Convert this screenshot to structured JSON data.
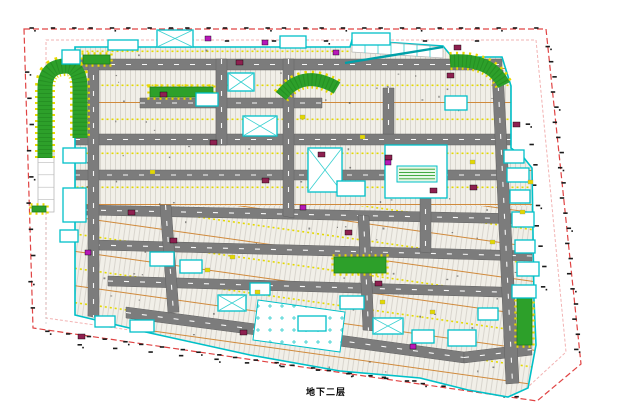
{
  "label": {
    "text": "地下二层"
  },
  "canvas": {
    "w": 627,
    "h": 415,
    "bg": "#ffffff"
  },
  "colors": {
    "boundary_red": "#e04343",
    "boundary_pink": "#f2b3b3",
    "outline_cyan": "#00c0c8",
    "teal_dark": "#00a0a8",
    "road_gray": "#7c7c7c",
    "road_edge": "#626262",
    "stall_bg": "#f1efe8",
    "stall_line": "#c9c5bd",
    "stall_orange": "#d08a3c",
    "lane_yellow": "#e3d800",
    "green_fill": "#2da02a",
    "green_edge": "#1e7f1c",
    "hedge_yellow": "#ead800",
    "maroon": "#8e2050",
    "magenta": "#b818b8",
    "tick_black": "#1a1a1a",
    "white": "#ffffff",
    "cross_cyan": "#38d0d0",
    "ramp_gray": "#b8b8b8"
  },
  "boundary": {
    "outer": [
      [
        24,
        29
      ],
      [
        546,
        29
      ],
      [
        581,
        364
      ],
      [
        537,
        401
      ],
      [
        33,
        328
      ]
    ],
    "inner": [
      [
        46,
        40
      ],
      [
        536,
        40
      ],
      [
        566,
        352
      ],
      [
        528,
        387
      ],
      [
        46,
        318
      ]
    ]
  },
  "tick_rows": [
    {
      "a": [
        24,
        29
      ],
      "b": [
        546,
        29
      ],
      "n": 27
    },
    {
      "a": [
        549,
        40
      ],
      "b": [
        579,
        358
      ],
      "n": 21
    },
    {
      "a": [
        529,
        115
      ],
      "b": [
        545,
        298
      ],
      "n": 9
    },
    {
      "a": [
        40,
        331
      ],
      "b": [
        528,
        399
      ],
      "n": 26
    },
    {
      "a": [
        65,
        344
      ],
      "b": [
        500,
        391
      ],
      "n": 13
    },
    {
      "a": [
        29,
        60
      ],
      "b": [
        32,
        322
      ],
      "n": 10
    },
    {
      "a": [
        100,
        42
      ],
      "b": [
        500,
        42
      ],
      "n": 8
    }
  ],
  "garage": {
    "outline": [
      [
        75,
        47
      ],
      [
        350,
        47
      ],
      [
        352,
        40
      ],
      [
        443,
        46
      ],
      [
        452,
        57
      ],
      [
        502,
        57
      ],
      [
        511,
        86
      ],
      [
        511,
        148
      ],
      [
        524,
        158
      ],
      [
        532,
        168
      ],
      [
        534,
        300
      ],
      [
        536,
        345
      ],
      [
        528,
        388
      ],
      [
        508,
        397
      ],
      [
        468,
        390
      ],
      [
        420,
        378
      ],
      [
        340,
        371
      ],
      [
        250,
        355
      ],
      [
        150,
        333
      ],
      [
        75,
        315
      ]
    ],
    "pattern_split_y": 206,
    "noise_count": 150,
    "noise_seed": 7
  },
  "roads": {
    "h": [
      [
        [
          78,
          59
        ],
        [
          502,
          59
        ],
        [
          502,
          70
        ],
        [
          78,
          70
        ]
      ],
      [
        [
          140,
          98
        ],
        [
          322,
          98
        ],
        [
          322,
          108
        ],
        [
          140,
          108
        ]
      ],
      [
        [
          75,
          134
        ],
        [
          524,
          134
        ],
        [
          524,
          145
        ],
        [
          75,
          145
        ]
      ],
      [
        [
          75,
          170
        ],
        [
          526,
          170
        ],
        [
          526,
          180
        ],
        [
          75,
          180
        ]
      ],
      [
        [
          85,
          205
        ],
        [
          529,
          214
        ],
        [
          529,
          224
        ],
        [
          85,
          215
        ]
      ],
      [
        [
          95,
          240
        ],
        [
          532,
          251
        ],
        [
          532,
          261
        ],
        [
          95,
          250
        ]
      ],
      [
        [
          108,
          276
        ],
        [
          534,
          288
        ],
        [
          534,
          298
        ],
        [
          108,
          286
        ]
      ],
      [
        [
          126,
          307
        ],
        [
          302,
          330
        ],
        [
          302,
          341
        ],
        [
          126,
          318
        ]
      ],
      [
        [
          302,
          330
        ],
        [
          464,
          352
        ],
        [
          464,
          363
        ],
        [
          302,
          341
        ]
      ],
      [
        [
          464,
          352
        ],
        [
          531,
          344
        ],
        [
          532,
          355
        ],
        [
          464,
          363
        ]
      ]
    ],
    "v": [
      [
        [
          88,
          59
        ],
        [
          99,
          59
        ],
        [
          99,
          318
        ],
        [
          88,
          316
        ]
      ],
      [
        [
          216,
          59
        ],
        [
          227,
          59
        ],
        [
          227,
          145
        ],
        [
          216,
          145
        ]
      ],
      [
        [
          283,
          59
        ],
        [
          294,
          59
        ],
        [
          294,
          218
        ],
        [
          283,
          216
        ]
      ],
      [
        [
          383,
          88
        ],
        [
          394,
          88
        ],
        [
          394,
          134
        ],
        [
          383,
          134
        ]
      ],
      [
        [
          420,
          145
        ],
        [
          431,
          145
        ],
        [
          431,
          253
        ],
        [
          420,
          252
        ]
      ],
      [
        [
          492,
          70
        ],
        [
          503,
          70
        ],
        [
          519,
          383
        ],
        [
          506,
          384
        ]
      ],
      [
        [
          160,
          205
        ],
        [
          171,
          205
        ],
        [
          179,
          312
        ],
        [
          168,
          313
        ]
      ],
      [
        [
          358,
          215
        ],
        [
          369,
          216
        ],
        [
          374,
          331
        ],
        [
          363,
          330
        ]
      ]
    ]
  },
  "ramp": {
    "outline": [
      [
        352,
        40
      ],
      [
        443,
        47
      ],
      [
        443,
        58
      ],
      [
        352,
        52
      ]
    ],
    "stripes": 6,
    "edge": [
      [
        345,
        63
      ],
      [
        443,
        47
      ]
    ]
  },
  "left_ramp": {
    "x": 38,
    "y": 150,
    "w": 16,
    "h": 62
  },
  "plaza": {
    "outline": [
      [
        258,
        300
      ],
      [
        345,
        312
      ],
      [
        340,
        352
      ],
      [
        253,
        340
      ]
    ]
  },
  "greens": {
    "strokes": [
      {
        "d": "M 45 158 L 45 88 Q 45 66 66 66 Q 80 66 80 88 L 80 138",
        "w": 15
      },
      {
        "d": "M 281 96 Q 303 68 337 88",
        "w": 13
      },
      {
        "d": "M 450 61 Q 491 58 504 85",
        "w": 13
      }
    ],
    "bars": [
      {
        "x": 83,
        "y": 55,
        "w": 27,
        "h": 9
      },
      {
        "x": 150,
        "y": 87,
        "w": 63,
        "h": 10
      },
      {
        "x": 334,
        "y": 257,
        "w": 52,
        "h": 16
      },
      {
        "x": 517,
        "y": 297,
        "w": 15,
        "h": 48
      },
      {
        "x": 32,
        "y": 206,
        "w": 14,
        "h": 6
      }
    ]
  },
  "cores": [
    {
      "x": 108,
      "y": 40,
      "w": 30,
      "h": 10
    },
    {
      "x": 157,
      "y": 30,
      "w": 36,
      "h": 17,
      "d": 1
    },
    {
      "x": 352,
      "y": 33,
      "w": 38,
      "h": 12
    },
    {
      "x": 280,
      "y": 36,
      "w": 26,
      "h": 12
    },
    {
      "x": 62,
      "y": 50,
      "w": 18,
      "h": 14
    },
    {
      "x": 228,
      "y": 73,
      "w": 26,
      "h": 18,
      "d": 1
    },
    {
      "x": 196,
      "y": 93,
      "w": 22,
      "h": 13
    },
    {
      "x": 243,
      "y": 116,
      "w": 34,
      "h": 20,
      "d": 1
    },
    {
      "x": 445,
      "y": 96,
      "w": 22,
      "h": 14
    },
    {
      "x": 308,
      "y": 148,
      "w": 34,
      "h": 44,
      "d": 1
    },
    {
      "x": 385,
      "y": 145,
      "w": 62,
      "h": 53
    },
    {
      "x": 337,
      "y": 181,
      "w": 28,
      "h": 15
    },
    {
      "x": 63,
      "y": 148,
      "w": 23,
      "h": 15
    },
    {
      "x": 63,
      "y": 188,
      "w": 23,
      "h": 34
    },
    {
      "x": 60,
      "y": 230,
      "w": 18,
      "h": 12
    },
    {
      "x": 504,
      "y": 150,
      "w": 20,
      "h": 13
    },
    {
      "x": 507,
      "y": 168,
      "w": 22,
      "h": 14
    },
    {
      "x": 510,
      "y": 190,
      "w": 20,
      "h": 13
    },
    {
      "x": 512,
      "y": 212,
      "w": 22,
      "h": 15
    },
    {
      "x": 515,
      "y": 240,
      "w": 20,
      "h": 13
    },
    {
      "x": 517,
      "y": 262,
      "w": 22,
      "h": 14
    },
    {
      "x": 512,
      "y": 285,
      "w": 24,
      "h": 13
    },
    {
      "x": 150,
      "y": 252,
      "w": 24,
      "h": 14
    },
    {
      "x": 180,
      "y": 260,
      "w": 22,
      "h": 13
    },
    {
      "x": 218,
      "y": 295,
      "w": 28,
      "h": 16,
      "d": 1
    },
    {
      "x": 250,
      "y": 283,
      "w": 20,
      "h": 12
    },
    {
      "x": 298,
      "y": 316,
      "w": 28,
      "h": 15
    },
    {
      "x": 340,
      "y": 296,
      "w": 24,
      "h": 13
    },
    {
      "x": 373,
      "y": 318,
      "w": 30,
      "h": 16,
      "d": 1
    },
    {
      "x": 412,
      "y": 330,
      "w": 22,
      "h": 13
    },
    {
      "x": 448,
      "y": 330,
      "w": 28,
      "h": 16
    },
    {
      "x": 478,
      "y": 308,
      "w": 20,
      "h": 12
    },
    {
      "x": 95,
      "y": 316,
      "w": 20,
      "h": 11
    },
    {
      "x": 130,
      "y": 320,
      "w": 24,
      "h": 12
    }
  ],
  "atrium": {
    "x": 397,
    "y": 166,
    "w": 40,
    "h": 16
  },
  "accents": {
    "maroon": [
      [
        160,
        92
      ],
      [
        236,
        60
      ],
      [
        454,
        45
      ],
      [
        210,
        140
      ],
      [
        262,
        178
      ],
      [
        318,
        152
      ],
      [
        430,
        188
      ],
      [
        128,
        210
      ],
      [
        170,
        238
      ],
      [
        345,
        230
      ],
      [
        375,
        281
      ],
      [
        240,
        330
      ],
      [
        447,
        73
      ],
      [
        385,
        155
      ],
      [
        470,
        185
      ],
      [
        78,
        334
      ],
      [
        513,
        122
      ]
    ],
    "magenta": [
      [
        205,
        36
      ],
      [
        333,
        50
      ],
      [
        385,
        160
      ],
      [
        300,
        205
      ],
      [
        410,
        344
      ],
      [
        85,
        250
      ],
      [
        262,
        40
      ]
    ],
    "yellow": [
      [
        300,
        115
      ],
      [
        360,
        135
      ],
      [
        470,
        160
      ],
      [
        520,
        210
      ],
      [
        490,
        240
      ],
      [
        380,
        300
      ],
      [
        430,
        310
      ],
      [
        205,
        268
      ],
      [
        255,
        290
      ],
      [
        528,
        180
      ],
      [
        150,
        170
      ],
      [
        230,
        255
      ]
    ]
  }
}
